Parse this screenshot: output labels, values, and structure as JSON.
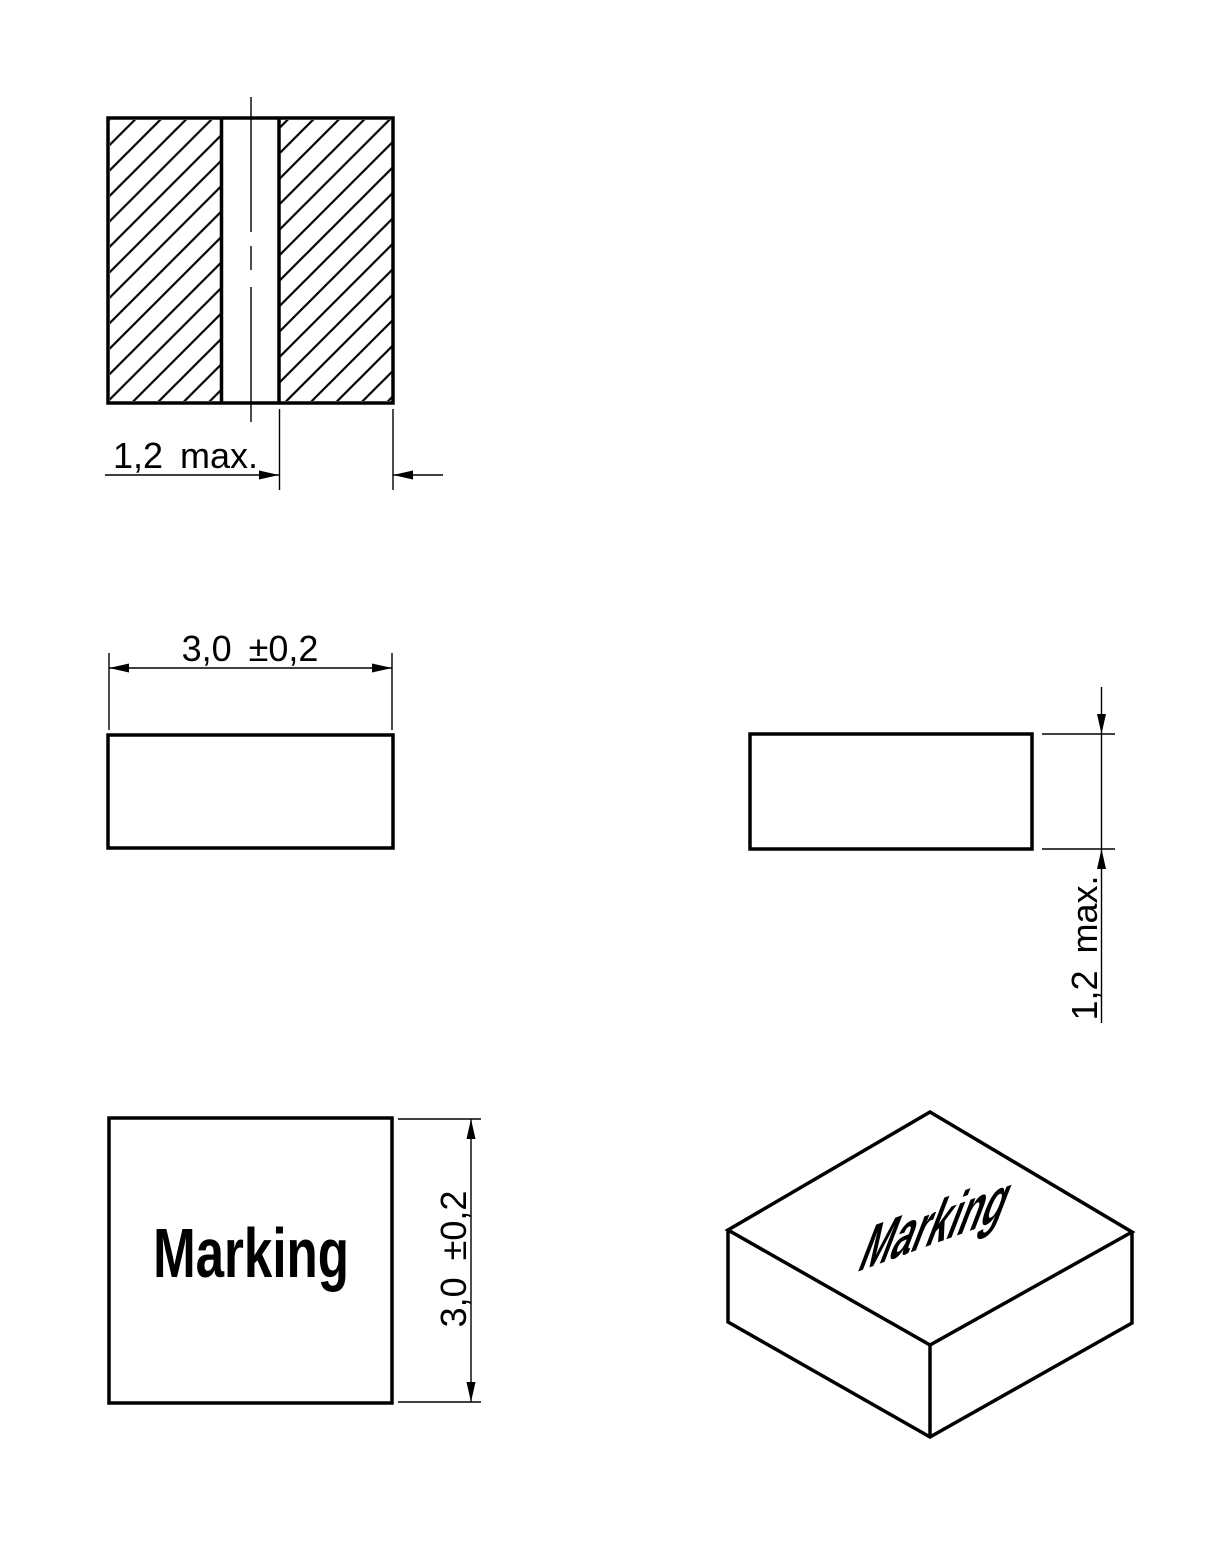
{
  "colors": {
    "background": "#ffffff",
    "line": "#000000"
  },
  "views": {
    "section_view": {
      "dimension_label": "1,2 max."
    },
    "front_view": {
      "dimension_label": "3,0 ±0,2"
    },
    "side_view": {
      "dimension_label": "1,2 max."
    },
    "top_view": {
      "marking": "Marking",
      "dimension_label": "3,0 ±0,2"
    },
    "isometric_view": {
      "marking": "Marking"
    }
  }
}
